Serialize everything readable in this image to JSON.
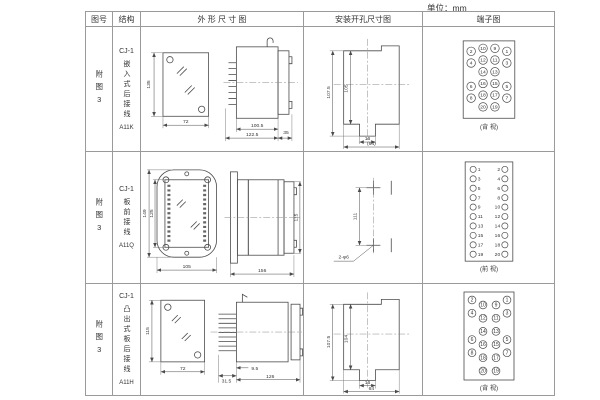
{
  "unit_label": "单位：mm",
  "table": {
    "headers": {
      "fig_no": "图号",
      "structure": "结构",
      "outline": "外 形 尺 寸 图",
      "install": "安装开孔尺寸图",
      "terminal": "端子图"
    },
    "rows": [
      {
        "fig_no": "附图3",
        "series": "CJ-1",
        "structure": "嵌入式后接线",
        "model": "A11K",
        "outline": {
          "front_h": "135",
          "front_w": "72",
          "side_d1": "100.5",
          "side_d2": "122.5",
          "side_d3": "35"
        },
        "install": {
          "v_outer": "107.5",
          "v_inner": "105",
          "slot_w": "16",
          "width": "(64)"
        },
        "terminal": {
          "view": "(背 视)",
          "grid": [
            [
              2,
              10,
              9,
              1
            ],
            [
              4,
              12,
              11,
              3
            ],
            [
              null,
              14,
              13,
              null
            ],
            [
              6,
              16,
              15,
              5
            ],
            [
              8,
              18,
              17,
              7
            ],
            [
              null,
              20,
              19,
              null
            ]
          ]
        }
      },
      {
        "fig_no": "附图3",
        "series": "CJ-1",
        "structure": "板前接线",
        "model": "A11Q",
        "outline": {
          "front_h_outer": "149",
          "front_h_inner": "125",
          "front_w": "105",
          "side_len": "156",
          "side_h": "115"
        },
        "install": {
          "spacing": "111",
          "holes": "2-φ6"
        },
        "terminal": {
          "view": "(前 视)",
          "grid": [
            [
              1,
              2
            ],
            [
              3,
              4
            ],
            [
              5,
              6
            ],
            [
              7,
              8
            ],
            [
              9,
              10
            ],
            [
              11,
              12
            ],
            [
              13,
              14
            ],
            [
              15,
              16
            ],
            [
              17,
              18
            ],
            [
              19,
              20
            ]
          ]
        }
      },
      {
        "fig_no": "附图3",
        "series": "CJ-1",
        "structure": "凸出式板后接线",
        "model": "A11H",
        "outline": {
          "front_h": "115",
          "front_w": "72",
          "side_d1": "31.5",
          "side_d2": "9.5",
          "side_d3": "126"
        },
        "install": {
          "v_outer": "107.5",
          "v_inner": "104",
          "slot_w": "16",
          "width": "64"
        },
        "terminal": {
          "view": "(背 视)",
          "grid": [
            [
              2,
              10,
              9,
              1
            ],
            [
              4,
              12,
              11,
              3
            ],
            [
              null,
              14,
              13,
              null
            ],
            [
              6,
              16,
              15,
              5
            ],
            [
              8,
              18,
              17,
              7
            ],
            [
              null,
              20,
              19,
              null
            ]
          ]
        }
      }
    ]
  }
}
